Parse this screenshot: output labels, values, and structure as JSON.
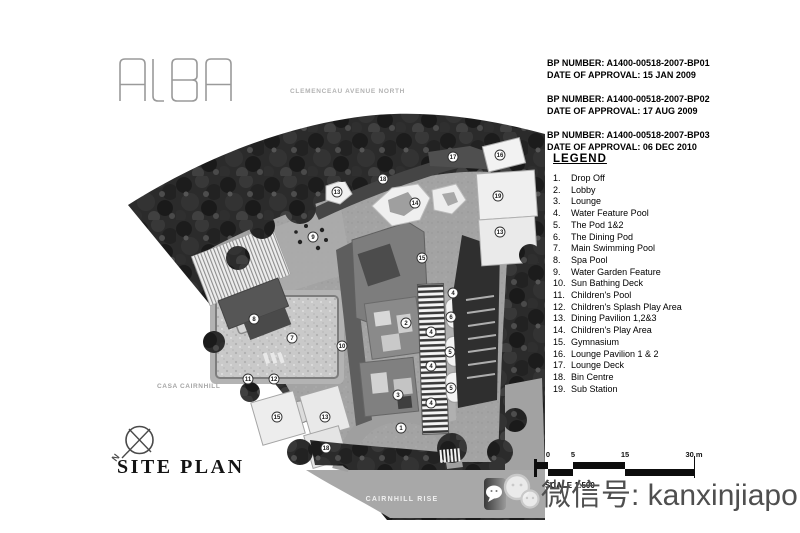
{
  "logo": {
    "text": "ALBA"
  },
  "street_label": "CLEMENCEAU AVENUE NORTH",
  "approvals": [
    {
      "line1": "BP NUMBER: A1400-00518-2007-BP01",
      "line2": "DATE OF APPROVAL: 15 JAN 2009"
    },
    {
      "line1": "BP NUMBER: A1400-00518-2007-BP02",
      "line2": "DATE OF APPROVAL: 17 AUG 2009"
    },
    {
      "line1": "BP NUMBER: A1400-00518-2007-BP03",
      "line2": "DATE OF APPROVAL: 06 DEC 2010"
    }
  ],
  "legend": {
    "title": "LEGEND",
    "items": [
      {
        "num": "1.",
        "label": "Drop Off"
      },
      {
        "num": "2.",
        "label": "Lobby"
      },
      {
        "num": "3.",
        "label": "Lounge"
      },
      {
        "num": "4.",
        "label": "Water Feature Pool"
      },
      {
        "num": "5.",
        "label": "The Pod 1&2"
      },
      {
        "num": "6.",
        "label": "The Dining Pod"
      },
      {
        "num": "7.",
        "label": "Main Swimming Pool"
      },
      {
        "num": "8.",
        "label": "Spa Pool"
      },
      {
        "num": "9.",
        "label": "Water Garden Feature"
      },
      {
        "num": "10.",
        "label": "Sun Bathing Deck"
      },
      {
        "num": "11.",
        "label": "Children's Pool"
      },
      {
        "num": "12.",
        "label": "Children's Splash Play Area"
      },
      {
        "num": "13.",
        "label": "Dining Pavilion 1,2&3"
      },
      {
        "num": "14.",
        "label": "Children's Play Area"
      },
      {
        "num": "15.",
        "label": "Gymnasium"
      },
      {
        "num": "16.",
        "label": "Lounge Pavilion 1 & 2"
      },
      {
        "num": "17.",
        "label": "Lounge Deck"
      },
      {
        "num": "18.",
        "label": "Bin Centre"
      },
      {
        "num": "19.",
        "label": "Sub Station"
      }
    ]
  },
  "site_plan": {
    "labels": {
      "casa_cairnhill": "CASA CAIRNHILL",
      "cairnhill_rise": "CAIRNHILL RISE",
      "north_letter": "N"
    },
    "markers": [
      {
        "n": "17",
        "x": 453,
        "y": 157
      },
      {
        "n": "16",
        "x": 500,
        "y": 155
      },
      {
        "n": "18",
        "x": 383,
        "y": 179
      },
      {
        "n": "13",
        "x": 337,
        "y": 192
      },
      {
        "n": "19",
        "x": 498,
        "y": 196
      },
      {
        "n": "14",
        "x": 415,
        "y": 203
      },
      {
        "n": "13",
        "x": 500,
        "y": 232
      },
      {
        "n": "9",
        "x": 313,
        "y": 237
      },
      {
        "n": "15",
        "x": 422,
        "y": 258
      },
      {
        "n": "4",
        "x": 453,
        "y": 293
      },
      {
        "n": "6",
        "x": 451,
        "y": 317
      },
      {
        "n": "8",
        "x": 254,
        "y": 319
      },
      {
        "n": "2",
        "x": 406,
        "y": 323
      },
      {
        "n": "4",
        "x": 431,
        "y": 332
      },
      {
        "n": "7",
        "x": 292,
        "y": 338
      },
      {
        "n": "10",
        "x": 342,
        "y": 346
      },
      {
        "n": "5",
        "x": 450,
        "y": 352
      },
      {
        "n": "4",
        "x": 431,
        "y": 366
      },
      {
        "n": "11",
        "x": 248,
        "y": 379
      },
      {
        "n": "12",
        "x": 274,
        "y": 379
      },
      {
        "n": "5",
        "x": 451,
        "y": 388
      },
      {
        "n": "3",
        "x": 398,
        "y": 395
      },
      {
        "n": "4",
        "x": 431,
        "y": 403
      },
      {
        "n": "15",
        "x": 277,
        "y": 417
      },
      {
        "n": "13",
        "x": 325,
        "y": 417
      },
      {
        "n": "1",
        "x": 401,
        "y": 428
      },
      {
        "n": "18",
        "x": 326,
        "y": 448
      }
    ]
  },
  "title": "SITE PLAN",
  "scale_bar": {
    "ticks": [
      {
        "label": "0",
        "x": 548
      },
      {
        "label": "5",
        "x": 573
      },
      {
        "label": "15",
        "x": 625
      },
      {
        "label": "30 m",
        "x": 694
      }
    ],
    "caption": "SCALE 1:500"
  },
  "watermark": {
    "text": "微信号: kanxinjiapo"
  },
  "colors": {
    "tree": "#2b2b2b",
    "hardscape": "#9a9a9a",
    "road": "#a8a8a8",
    "building": "#efefef",
    "ink": "#000000"
  }
}
